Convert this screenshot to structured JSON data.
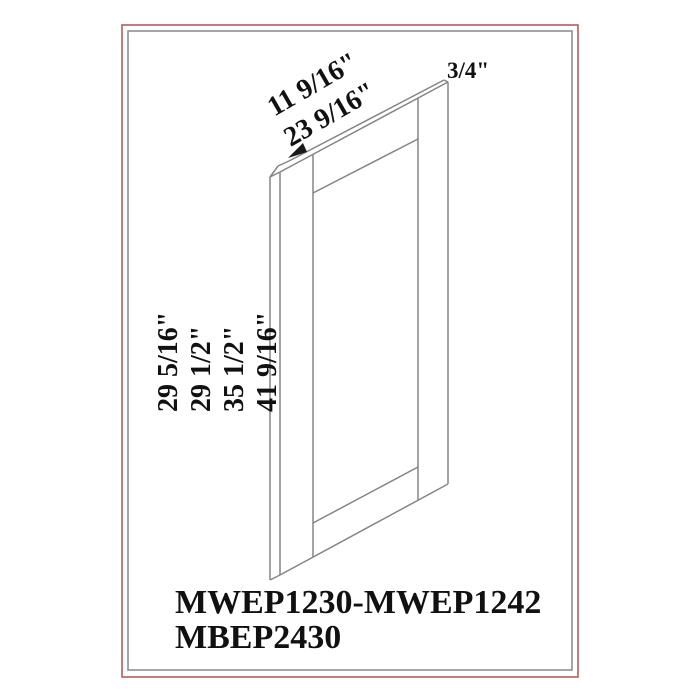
{
  "frame": {
    "outer_border_color": "#b25e5e",
    "inner_border_color": "#8f8f8f"
  },
  "drawing": {
    "description": "isometric wireframe of shaker-style cabinet end panel",
    "line_color": "#858585",
    "dimensions": {
      "width_label_1": "11 9/16\"",
      "width_label_2": "23 9/16\"",
      "thickness_label": "3/4\"",
      "height_label_1": "29 5/16\"",
      "height_label_2": "29 1/2\"",
      "height_label_3": "35 1/2\"",
      "height_label_4": "41 9/16\""
    }
  },
  "product_codes": {
    "line1": "MWEP1230-MWEP1242",
    "line2": "MBEP2430"
  }
}
